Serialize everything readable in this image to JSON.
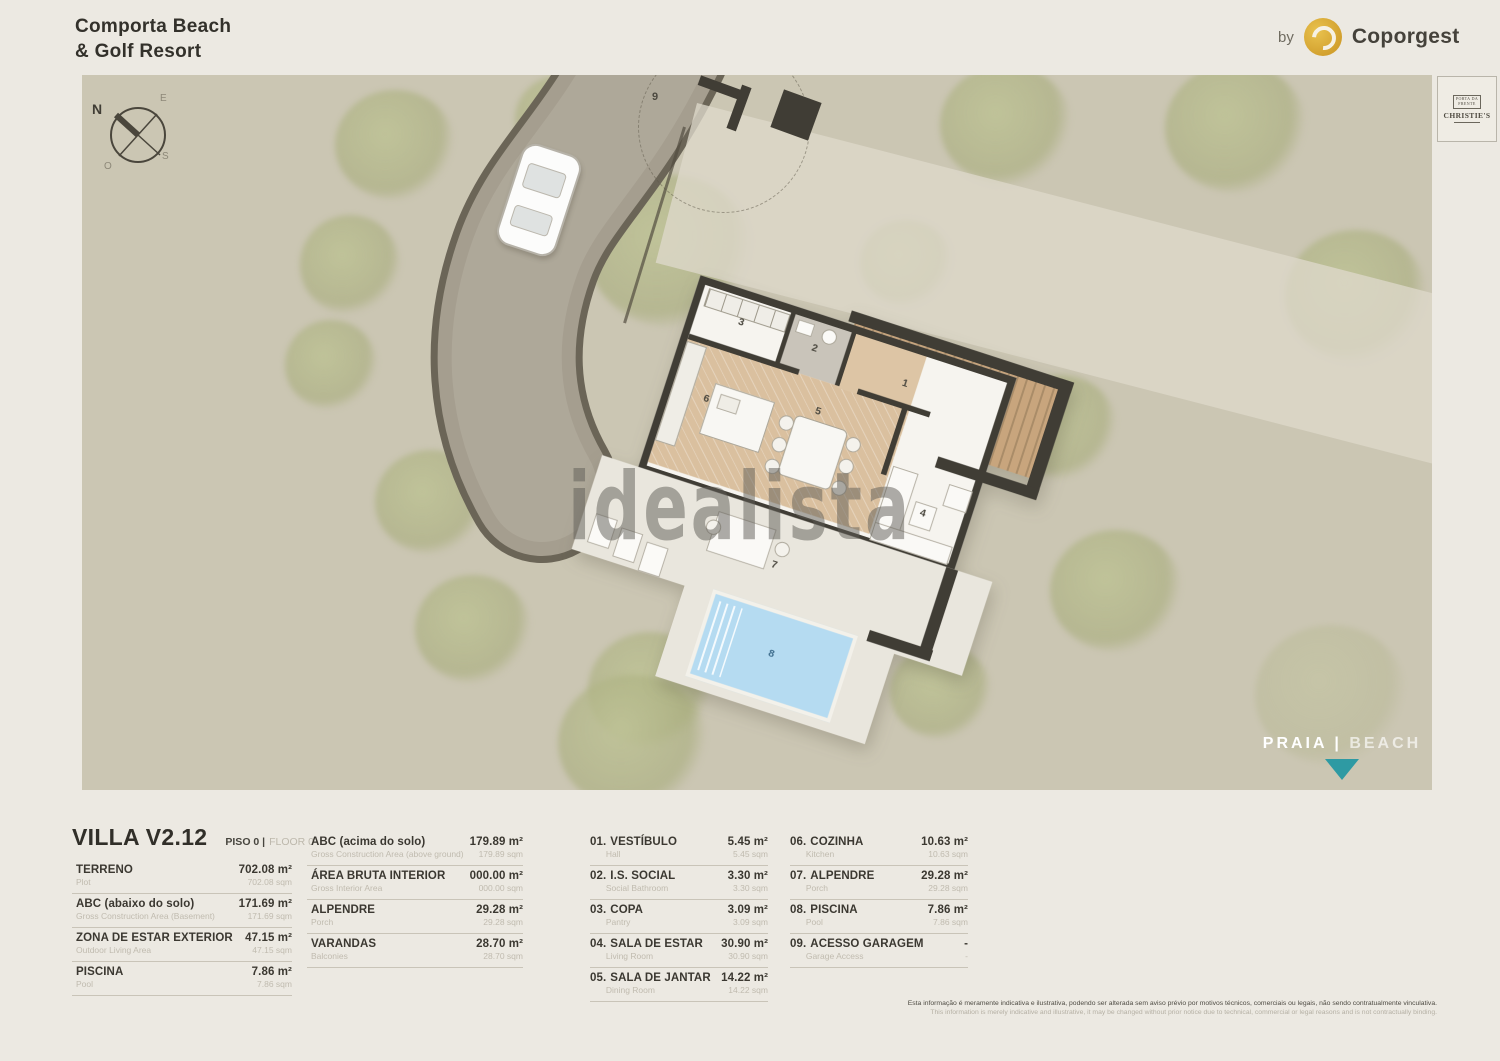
{
  "header": {
    "title_line1": "Comporta Beach",
    "title_line2": "& Golf Resort",
    "by": "by",
    "brand": "Coporgest"
  },
  "christies": {
    "top1": "PORTA DA",
    "top2": "FRENTE",
    "name": "CHRISTIE'S"
  },
  "plan": {
    "compass": {
      "n": "N",
      "e": "E",
      "s": "S",
      "o": "O"
    },
    "room_labels": {
      "r1": "1",
      "r2": "2",
      "r3": "3",
      "r4": "4",
      "r5": "5",
      "r6": "6",
      "r7": "7",
      "r8": "8",
      "r9": "9"
    },
    "beach": {
      "pt": "PRAIA",
      "sep": " | ",
      "en": "BEACH"
    }
  },
  "watermark": "idealista",
  "legend": {
    "title": "VILLA V2.12",
    "floor_pt": "PISO 0 |",
    "floor_en": "FLOOR 0",
    "col1": [
      {
        "label": "TERRENO",
        "sub": "Plot",
        "value": "702.08 m²",
        "subvalue": "702.08 sqm"
      },
      {
        "label": "ABC (abaixo do solo)",
        "sub": "Gross Construction Area (Basement)",
        "value": "171.69 m²",
        "subvalue": "171.69 sqm"
      },
      {
        "label": "ZONA DE ESTAR EXTERIOR",
        "sub": "Outdoor Living Area",
        "value": "47.15 m²",
        "subvalue": "47.15 sqm"
      },
      {
        "label": "PISCINA",
        "sub": "Pool",
        "value": "7.86 m²",
        "subvalue": "7.86 sqm"
      }
    ],
    "col2": [
      {
        "label": "ABC (acima do solo)",
        "sub": "Gross Construction Area (above ground)",
        "value": "179.89 m²",
        "subvalue": "179.89 sqm"
      },
      {
        "label": "ÁREA BRUTA INTERIOR",
        "sub": "Gross Interior Area",
        "value": "000.00 m²",
        "subvalue": "000.00 sqm"
      },
      {
        "label": "ALPENDRE",
        "sub": "Porch",
        "value": "29.28 m²",
        "subvalue": "29.28 sqm"
      },
      {
        "label": "VARANDAS",
        "sub": "Balconies",
        "value": "28.70 m²",
        "subvalue": "28.70 sqm"
      }
    ],
    "col3": [
      {
        "num": "01.",
        "label": "VESTÍBULO",
        "sub": "Hall",
        "value": "5.45 m²",
        "subvalue": "5.45 sqm"
      },
      {
        "num": "02.",
        "label": "I.S. SOCIAL",
        "sub": "Social Bathroom",
        "value": "3.30 m²",
        "subvalue": "3.30 sqm"
      },
      {
        "num": "03.",
        "label": "COPA",
        "sub": "Pantry",
        "value": "3.09 m²",
        "subvalue": "3.09 sqm"
      },
      {
        "num": "04.",
        "label": "SALA DE ESTAR",
        "sub": "Living Room",
        "value": "30.90 m²",
        "subvalue": "30.90 sqm"
      },
      {
        "num": "05.",
        "label": "SALA DE JANTAR",
        "sub": "Dining Room",
        "value": "14.22 m²",
        "subvalue": "14.22 sqm"
      }
    ],
    "col4": [
      {
        "num": "06.",
        "label": "COZINHA",
        "sub": "Kitchen",
        "value": "10.63 m²",
        "subvalue": "10.63 sqm"
      },
      {
        "num": "07.",
        "label": "ALPENDRE",
        "sub": "Porch",
        "value": "29.28 m²",
        "subvalue": "29.28 sqm"
      },
      {
        "num": "08.",
        "label": "PISCINA",
        "sub": "Pool",
        "value": "7.86 m²",
        "subvalue": "7.86 sqm"
      },
      {
        "num": "09.",
        "label": "ACESSO GARAGEM",
        "sub": "Garage Access",
        "value": "-",
        "subvalue": "-"
      }
    ]
  },
  "disclaimer": {
    "pt": "Esta informação é meramente indicativa e ilustrativa, podendo ser alterada sem aviso prévio por motivos técnicos, comerciais ou legais, não sendo contratualmente vinculativa.",
    "en": "This information is merely indicative and illustrative, it may be changed without prior notice due to technical, commercial or legal reasons and is not contractually binding."
  },
  "colors": {
    "accent_teal": "#2E9AA3",
    "brand_gold": "#D4A43C",
    "plan_bg": "#CBC6B3",
    "page_bg": "#ECE9E2",
    "wall": "#403D35",
    "pool": "#B5DBF1"
  }
}
